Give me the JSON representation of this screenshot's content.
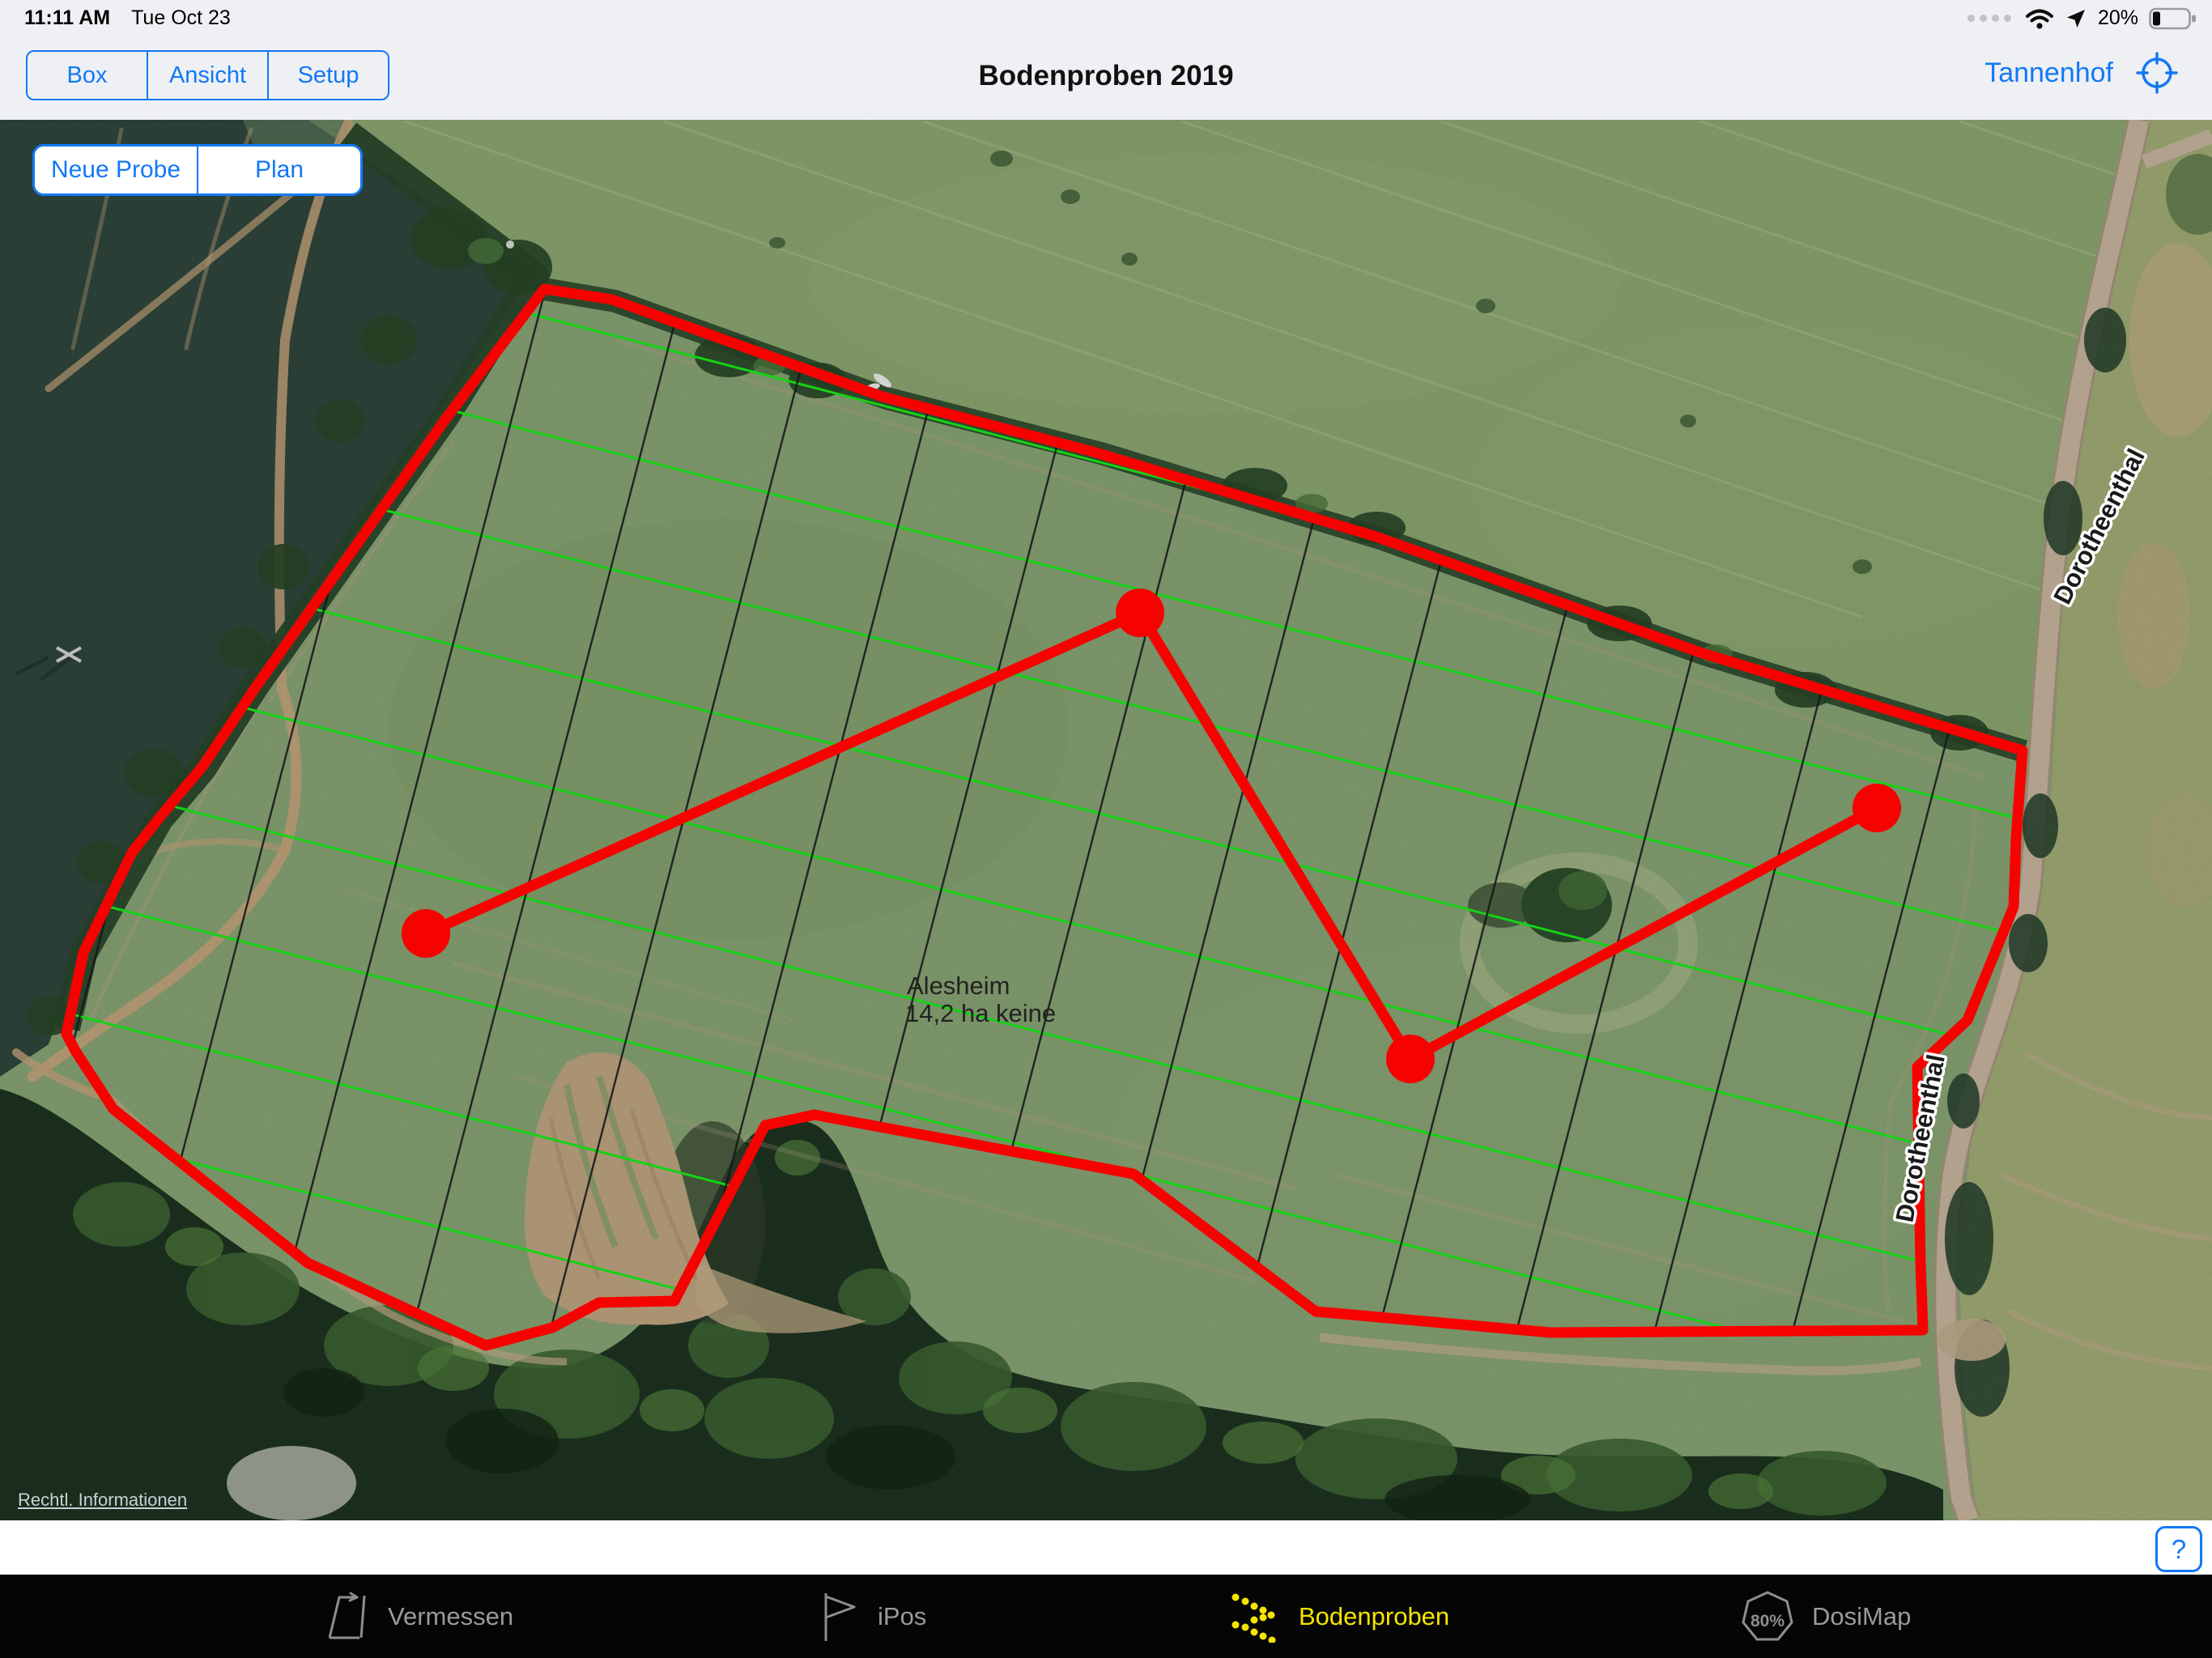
{
  "status_bar": {
    "time": "11:11 AM",
    "date": "Tue Oct 23",
    "battery_percent": "20%"
  },
  "nav_bar": {
    "segments": [
      "Box",
      "Ansicht",
      "Setup"
    ],
    "title": "Bodenproben 2019",
    "account_label": "Tannenhof"
  },
  "map_controls": {
    "buttons": [
      "Neue Probe",
      "Plan"
    ]
  },
  "map": {
    "field_label_line1": "Alesheim",
    "field_label_line2": "14,2 ha keine",
    "road_label_upper": "Dorotheenthal",
    "road_label_lower": "Dorotheenthal",
    "legal_link": "Rechtl. Informationen",
    "sample_point_count": 4
  },
  "help_button_label": "?",
  "tab_bar": {
    "tabs": [
      {
        "label": "Vermessen",
        "icon": "measure-parallelogram-icon",
        "active": false
      },
      {
        "label": "iPos",
        "icon": "flag-icon",
        "active": false
      },
      {
        "label": "Bodenproben",
        "icon": "soil-sample-dots-icon",
        "active": true
      },
      {
        "label": "DosiMap",
        "icon": "dosimap-heptagon-icon",
        "active": false,
        "badge": "80%"
      }
    ],
    "active_color": "#f5e400",
    "inactive_color": "#9a9a9a"
  },
  "colors": {
    "accent_blue": "#1278f5",
    "boundary_red": "#f60200",
    "grid_green": "#15d215",
    "grid_black": "#151515",
    "field_green": "#8ba877"
  }
}
